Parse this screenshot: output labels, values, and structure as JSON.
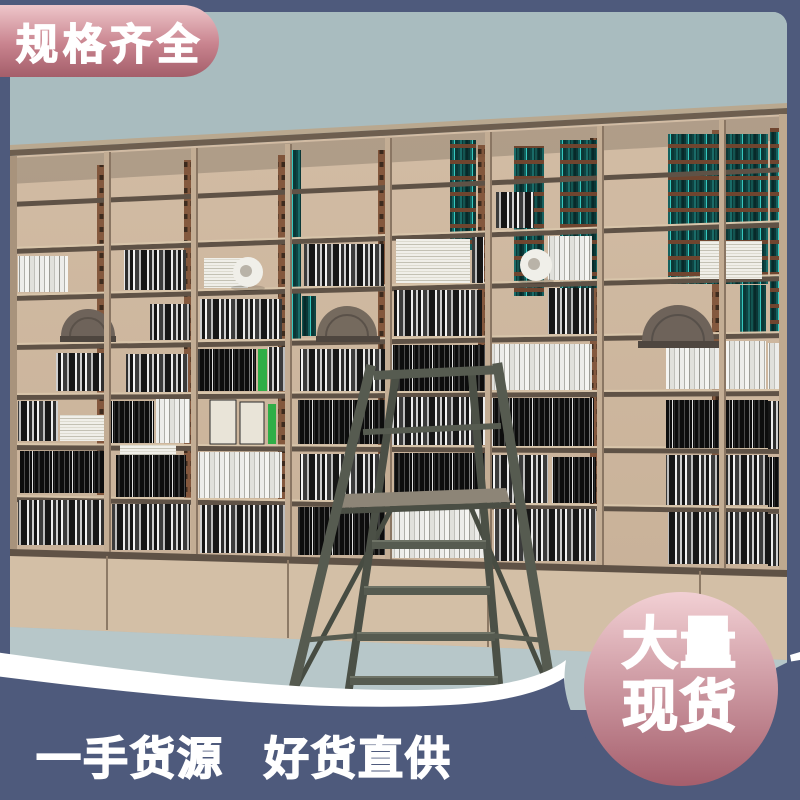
{
  "banner": {
    "label": "规格齐全"
  },
  "badge": {
    "line1": "大量",
    "line2": "现货"
  },
  "slogan": {
    "part1": "一手货源",
    "part2": "好货直供"
  },
  "theme": {
    "band": "#4e5a7c",
    "banner-top": "#eec6ca",
    "banner-bottom": "#a45e6a",
    "badge-top": "#f2d0d4",
    "badge-bottom": "#a55e6c",
    "sky": "#a9bcbf",
    "wood": "#cdb69e",
    "floor": "#b7c7c9",
    "ladder": "#565b50",
    "teal-accent": "#1a6b68",
    "text": "#ffffff"
  }
}
